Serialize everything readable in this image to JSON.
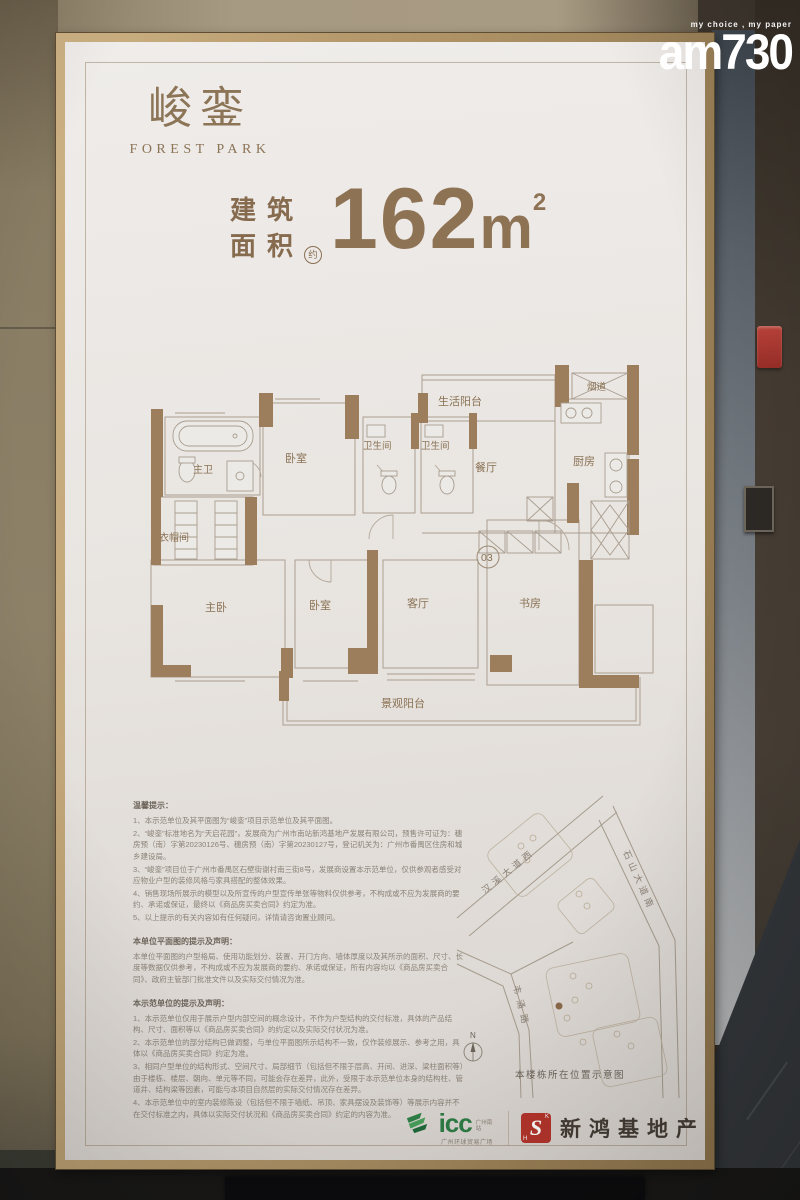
{
  "watermark": {
    "tagline": "my choice , my paper",
    "brand": "am730"
  },
  "poster": {
    "brand": {
      "cn": "峻銮",
      "en": "FOREST PARK"
    },
    "area": {
      "label1": "建筑",
      "label2": "面积",
      "approx": "约",
      "value": "162",
      "unit": "m",
      "power": "2"
    },
    "floorplan": {
      "unit_number": "03",
      "rooms": [
        "生活阳台",
        "烟道",
        "厨房",
        "餐厅",
        "卫生间",
        "卫生间",
        "卧室",
        "主卫",
        "衣帽间",
        "主卧",
        "卧室",
        "客厅",
        "书房",
        "景观阳台"
      ]
    },
    "notices": [
      {
        "title": "温馨提示：",
        "items": [
          "1、本示范单位及其平面图为“峻銮”项目示范单位及其平面图。",
          "2、“峻銮”标准地名为“天启花园”，发展商为广州市南站新鸿基地产发展有限公司，预售许可证为：穗房预（南）字第20230126号、穗房预（南）字第20230127号，登记机关为：广州市番禺区住房和城乡建设局。",
          "3、“峻銮”项目位于广州市番禺区石壁街谢村南三街8号，发展商设置本示范单位，仅供参观者感受对应物业户型的装修风格与家具搭配的整体效果。",
          "4、销售现场所展示的模型以及所宣传的户型宣传单张等物料仅供参考，不构成或不应为发展商的要约、承诺或保证，最终以《商品房买卖合同》约定为准。",
          "5、以上提示的有关内容如有任何疑问，详情请咨询置业顾问。"
        ]
      },
      {
        "title": "本单位平面图的提示及声明：",
        "items": [
          "本单位平面图的户型格局、使用功能划分、装置、开门方向、墙体厚度以及其所示的面积、尺寸、长度等数据仅供参考，不构成或不应为发展商的要约、承诺或保证，所有内容均以《商品房买卖合同》、政府主管部门批准文件以及实际交付情况为准。"
        ]
      },
      {
        "title": "本示范单位的提示及声明：",
        "items": [
          "1、本示范单位仅用于展示户型内部空间的概念设计，不作为户型结构的交付标准，具体的产品结构、尺寸、面积等以《商品房买卖合同》的约定以及实际交付状况为准。",
          "2、本示范单位的部分结构已做调整，与单位平面图所示结构不一致，仅作装修展示、参考之用，具体以《商品房买卖合同》约定为准。",
          "3、相同户型单位的结构形式、空间尺寸、局部细节（包括但不限于层高、开间、进深、梁柱面积等）由于楼栋、楼层、朝向、单元等不同，可能会存在差异，此外，受限于本示范单位本身的结构柱、管道井、结构梁等因素，可能与本项目自然层的实际交付情况存在差异。",
          "4、本示范单位中的室内装修陈设（包括但不限于墙纸、吊顶、家具摆设及装饰等）等展示内容并不在交付标准之内，具体以实际交付状况和《商品房买卖合同》约定的内容为准。"
        ]
      }
    ],
    "map": {
      "roads": [
        "汉溪大道西",
        "石山大道南",
        "韦涌路"
      ],
      "compass": "N",
      "caption": "本楼栋所在位置示意图"
    },
    "footer": {
      "icc": "icc",
      "icc_tag": "广州南站",
      "icc_sub": "广州环球贸易广场",
      "shk_badge": "S",
      "shk_badge_h": "H",
      "shk_badge_k": "K",
      "shk_name": "新鸿基地产"
    }
  }
}
